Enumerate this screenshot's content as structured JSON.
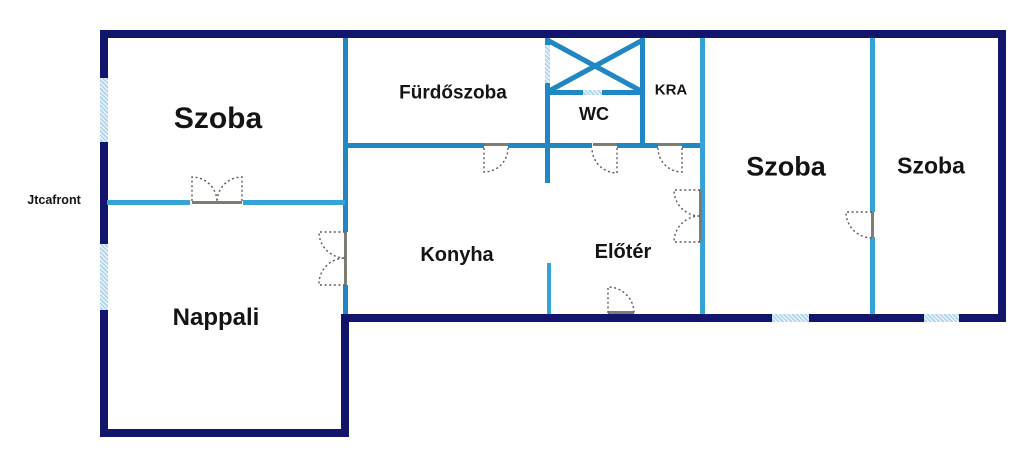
{
  "plan": {
    "rooms": [
      {
        "id": "szoba-left",
        "label": "Szoba"
      },
      {
        "id": "furdoszoba",
        "label": "Fürdőszoba"
      },
      {
        "id": "wc",
        "label": "WC"
      },
      {
        "id": "kra",
        "label": "KRA"
      },
      {
        "id": "szoba-middle",
        "label": "Szoba"
      },
      {
        "id": "szoba-right",
        "label": "Szoba"
      },
      {
        "id": "konyha",
        "label": "Konyha"
      },
      {
        "id": "eloter",
        "label": "Előtér"
      },
      {
        "id": "nappali",
        "label": "Nappali"
      }
    ],
    "annotations": [
      {
        "id": "street-front",
        "label": "Jtcafront"
      }
    ],
    "colors": {
      "outer_wall": "#11156b",
      "inner_wall": "#2187c4",
      "inner_wall_light": "#35a2d8",
      "window_fill": "#b3d6ec",
      "door_header": "#7d7d72",
      "door_arc": "#5a5a5a",
      "label": "#141414",
      "background": "#ffffff"
    }
  }
}
